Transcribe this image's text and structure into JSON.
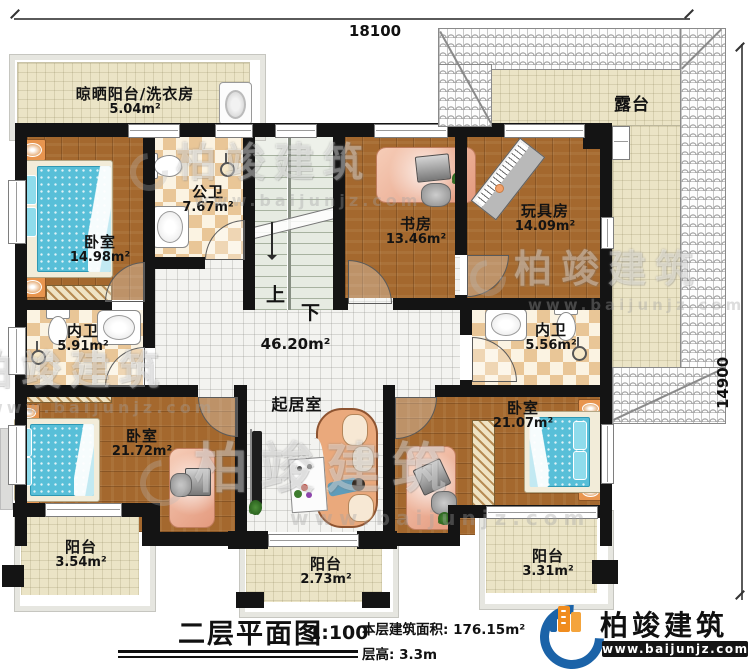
{
  "dimensions": {
    "top": "18100",
    "right": "14900"
  },
  "rooms": {
    "laundry": {
      "name": "晾晒阳台/洗衣房",
      "area": "5.04m²"
    },
    "terrace": {
      "name": "露台"
    },
    "bedroom_top": {
      "name": "卧室",
      "area": "14.98m²"
    },
    "public_bath": {
      "name": "公卫",
      "area": "7.67m²"
    },
    "study": {
      "name": "书房",
      "area": "13.46m²"
    },
    "toy_room": {
      "name": "玩具房",
      "area": "14.09m²"
    },
    "ensuite_left": {
      "name": "内卫",
      "area": "5.91m²"
    },
    "ensuite_right": {
      "name": "内卫",
      "area": "5.56m²"
    },
    "living": {
      "name": "起居室",
      "area": "46.20m²"
    },
    "bedroom_left": {
      "name": "卧室",
      "area": "21.72m²"
    },
    "bedroom_right": {
      "name": "卧室",
      "area": "21.07m²"
    },
    "balcony_left": {
      "name": "阳台",
      "area": "3.54m²"
    },
    "balcony_center": {
      "name": "阳台",
      "area": "2.73m²"
    },
    "balcony_right": {
      "name": "阳台",
      "area": "3.31m²"
    }
  },
  "stairs": {
    "up": "上",
    "down": "下"
  },
  "title_block": {
    "title": "二层平面图",
    "scale": "1:100",
    "floor_area": "本层建筑面积: 176.15m²",
    "floor_height": "层高: 3.3m"
  },
  "logo": {
    "name": "柏竣建筑",
    "url": "www.baijunjz.com"
  },
  "watermark": {
    "name": "柏竣建筑",
    "url": "www.baijunjz.com"
  },
  "colors": {
    "wall": "#141414",
    "wood": "#a4682e",
    "bed_blue": "#58bfd8",
    "logo_blue": "#1b63a8",
    "logo_orange": "#f08c1e"
  }
}
